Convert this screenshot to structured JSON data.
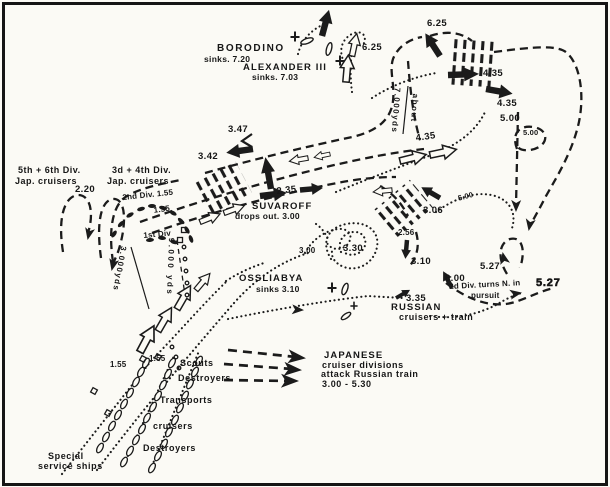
{
  "figure": {
    "type": "hand-drawn naval battle track chart",
    "background": "#fbfaf5",
    "ink": "#1b1b1b"
  },
  "events": {
    "borodino": {
      "name": "BORODINO",
      "note": "sinks. 7.20"
    },
    "alexander": {
      "name": "ALEXANDER III",
      "note": "sinks. 7.03"
    },
    "suvaroff": {
      "name": "SUVAROFF",
      "note": "drops out. 3.00"
    },
    "ossliabya": {
      "name": "OSSLIABYA",
      "note": "sinks 3.10"
    }
  },
  "forces": {
    "div56_line1": "5th + 6th Div.",
    "div56_line2": "Jap. cruisers",
    "div34_line1": "3d + 4th Div.",
    "div34_line2": "Jap. cruisers",
    "div2": "2nd Div. 1.55",
    "div1": "1st Div",
    "pursuit_line1": "2d Div. turns N. in",
    "pursuit_line2": "pursuit",
    "russian_line1": "RUSSIAN",
    "russian_line2": "cruisers + train",
    "attack_line1": "JAPANESE",
    "attack_line2": "cruiser divisions",
    "attack_line3": "attack Russian train",
    "attack_line4": "3.00 - 5.30",
    "scouts": "Scouts",
    "destroyers_upper": "Destroyers",
    "transports": "Transports",
    "cruisers": "cruisers",
    "destroyers_lower": "Destroyers",
    "special_line1": "Special",
    "special_line2": "service ships"
  },
  "ranges": {
    "top_word": "about",
    "top_value": "7.000yds",
    "left": "3.000yds",
    "right": "9.000 yds"
  },
  "times": {
    "t625_west": "6.25",
    "t625_east": "6.25",
    "t435_a": "4.35",
    "t435_b": "4.35",
    "t435_rus": "4.35",
    "t500_a": "5.00",
    "t500_loop": "5.00",
    "t500_small": "5.00",
    "t347": "3.47",
    "t342": "3.42",
    "t235": "2.35",
    "t306": "3.06",
    "t256": "2.56",
    "t330": "3.30",
    "t300": "3.00",
    "t310": "3.10",
    "t527_a": "5.27",
    "t527_b": "5.27",
    "t220": "2.20",
    "t155_line": "1.55",
    "t155_col1": "1.55",
    "t155_col2": "1.55",
    "t335": "3.35",
    "t600": "6.00"
  }
}
